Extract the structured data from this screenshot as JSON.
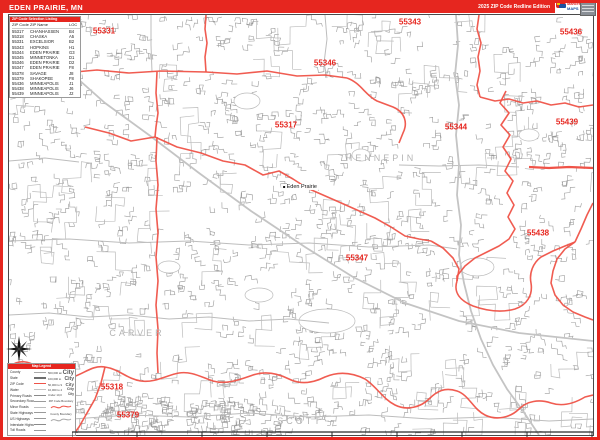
{
  "title_bar": {
    "title": "EDEN PRAIRIE, MN",
    "edition": "2025 ZIP Code Redline Edition"
  },
  "logo": {
    "brand_top": "Market",
    "brand_bottom": "MAPS"
  },
  "colors": {
    "accent_red": "#e6261f",
    "boundary_red": "#ef5348",
    "street_gray": "#909090",
    "county_gray": "#b4b4b4"
  },
  "zip_table": {
    "header": "ZIP Code Selection Listing",
    "columns": [
      "ZIP Code",
      "ZIP Name",
      "LOC"
    ],
    "rows": [
      [
        "55317",
        "CHANHASSEN",
        "B4"
      ],
      [
        "55318",
        "CHASKA",
        "A5"
      ],
      [
        "55331",
        "EXCELSIOR",
        "B2"
      ],
      [
        "55343",
        "HOPKINS",
        "H1"
      ],
      [
        "55344",
        "EDEN PRAIRIE",
        "G3"
      ],
      [
        "55345",
        "MINNETONKA",
        "D1"
      ],
      [
        "55346",
        "EDEN PRAIRIE",
        "D2"
      ],
      [
        "55347",
        "EDEN PRAIRIE",
        "F8"
      ],
      [
        "55378",
        "SAVAGE",
        "J8"
      ],
      [
        "55379",
        "SHAKOPEE",
        "F8"
      ],
      [
        "55436",
        "MINNEAPOLIS",
        "J1"
      ],
      [
        "55438",
        "MINNEAPOLIS",
        "J6"
      ],
      [
        "55439",
        "MINNEAPOLIS",
        "J2"
      ]
    ]
  },
  "legend": {
    "header": "Map Legend",
    "line_items": [
      {
        "label": "County",
        "color": "#aaaaaa",
        "w": 1.5
      },
      {
        "label": "State",
        "color": "#6e6e6e",
        "w": 2
      },
      {
        "label": "ZIP Code",
        "color": "#ef5348",
        "w": 1.5
      },
      {
        "label": "Water",
        "color": "#c4c4c4",
        "w": 1
      },
      {
        "label": "Primary Roads",
        "color": "#8a8a8a",
        "w": 1.5
      },
      {
        "label": "Secondary Roads",
        "color": "#9a9a9a",
        "w": 1
      },
      {
        "label": "Minor Roads",
        "color": "#bdbdbd",
        "w": 0.8
      },
      {
        "label": "State Highways",
        "color": "#9a9a9a",
        "w": 1
      },
      {
        "label": "US Highways",
        "color": "#9a9a9a",
        "w": 1
      },
      {
        "label": "Interstate Highways",
        "color": "#8a8a8a",
        "w": 1.4
      },
      {
        "label": "Toll Roads",
        "color": "#9a9a9a",
        "w": 1
      }
    ],
    "city_sizes": [
      {
        "caption": "500,000 and Over",
        "sample": "City",
        "size": 6
      },
      {
        "caption": "100,000 to 499,999",
        "sample": "City",
        "size": 5
      },
      {
        "caption": "50,000 to 99,999",
        "sample": "City",
        "size": 4.5
      },
      {
        "caption": "10,000 to 49,999",
        "sample": "City",
        "size": 3.8
      },
      {
        "caption": "Under 10,000",
        "sample": "City",
        "size": 3.2
      }
    ],
    "boundary_samples": [
      "ZIP Code Boundary",
      "County Boundary"
    ]
  },
  "map": {
    "zip_labels": [
      {
        "text": "55331",
        "x": 95,
        "y": 16
      },
      {
        "text": "55343",
        "x": 401,
        "y": 7
      },
      {
        "text": "55436",
        "x": 562,
        "y": 17
      },
      {
        "text": "55346",
        "x": 316,
        "y": 48
      },
      {
        "text": "55317",
        "x": 277,
        "y": 110
      },
      {
        "text": "55344",
        "x": 447,
        "y": 112
      },
      {
        "text": "55439",
        "x": 558,
        "y": 107
      },
      {
        "text": "55438",
        "x": 529,
        "y": 218
      },
      {
        "text": "55347",
        "x": 348,
        "y": 243
      },
      {
        "text": "55318",
        "x": 103,
        "y": 372
      },
      {
        "text": "55379",
        "x": 119,
        "y": 400
      }
    ],
    "county_labels": [
      {
        "text": "HENNEPIN",
        "x": 372,
        "y": 143
      },
      {
        "text": "CARVER",
        "x": 128,
        "y": 318
      },
      {
        "text": "SCOTT",
        "x": 291,
        "y": 406
      }
    ],
    "city_label": {
      "text": "Eden Prairie",
      "x": 291,
      "y": 172
    },
    "boundaries": [
      "M197,0 L196,14 198,28 196,42 197,57",
      "M0,57 L28,55 55,58 88,55 120,58 152,56 197,57 228,59 258,56 288,61 316,60 338,63",
      "M338,63 C352,68 356,80 368,86 L384,92 C396,97 399,108 394,118 L390,128",
      "M76,112 L100,118 122,126 146,122 168,132 192,138 214,146 236,150 254,160 270,156 284,164 298,173 314,180 330,187 348,195 366,203 382,212 396,221 410,224 422,226",
      "M422,226 L434,233 444,243 450,254 448,266",
      "M497,76 L491,88 500,98 492,110 501,120 494,132 502,144 496,156 504,166 498,178 505,190 499,202 506,214 500,224 490,231 478,237 466,243 456,251 448,261 448,266",
      "M448,266 C444,278 452,286 464,291 C478,296 492,298 506,294 C518,290 524,280 522,268 C520,258 524,248 532,242 L544,236 556,231 566,227",
      "M470,0 L468,14 472,28 469,42 471,56 468,70 471,82",
      "M471,82 L486,86 500,84 514,88 528,86 542,90 556,88 570,92 584,90",
      "M566,227 L556,234 548,244 544,256 542,268 546,280 554,290 564,297 576,302 584,305",
      "M566,227 L572,214 578,200 584,188",
      "M148,122 L147,146 149,170 147,194 149,218 147,242 149,266 147,290 149,314 148,338 149,358",
      "M148,57 L147,78 149,98 147,112 146,122",
      "M0,352 C10,344 20,346 28,352 C40,360 52,366 64,362 C76,358 84,350 96,352 C110,354 118,364 132,366 C146,368 158,360 170,358 C182,356 192,362 204,366 C218,370 232,364 244,360 C256,356 268,358 280,364 C292,370 304,368 316,362 C330,356 344,358 356,364 C368,372 374,384 386,390 C398,396 412,392 420,384 C428,376 436,372 448,376 C460,380 464,394 476,400 C488,406 502,402 510,394 C518,386 530,384 542,388 C554,392 566,388 576,382 L584,380",
      "M96,352 L92,368 86,384 78,398 70,412 64,420"
    ],
    "red_roads": [
      "M520,152 L540,153 560,152 584,153"
    ],
    "gray_roads_major": [
      "M60,56 L96,88 140,120 190,158 242,196 296,232 344,262 396,288 450,306 510,318 584,326",
      "M447,0 L449,30 446,60 450,90 447,120 450,150 448,180 452,210 450,240 455,268 462,296 472,324 484,350 498,374 514,396 530,420"
    ],
    "gray_roads_minor": [
      "M142,0 L142,30 143,57",
      "M0,226 L60,224 120,228 180,226 240,230 300,228 360,232 420,230 448,234",
      "M390,150 L430,151 470,150 510,152",
      "M0,300 L40,298 80,302 120,300 160,304 200,302 240,306 280,304 320,308",
      "M316,0 L318,24 315,48 318,63",
      "M0,146 L36,143 70,147",
      "M64,404 L120,400 180,402 240,398 300,402 360,400 420,404 480,402 540,406 584,404"
    ],
    "lakes": [
      [
        318,
        306,
        28,
        12
      ],
      [
        238,
        86,
        13,
        8
      ],
      [
        468,
        252,
        17,
        9
      ],
      [
        160,
        252,
        11,
        6
      ],
      [
        352,
        140,
        9,
        6
      ],
      [
        250,
        280,
        14,
        7
      ],
      [
        520,
        120,
        10,
        6
      ]
    ]
  }
}
